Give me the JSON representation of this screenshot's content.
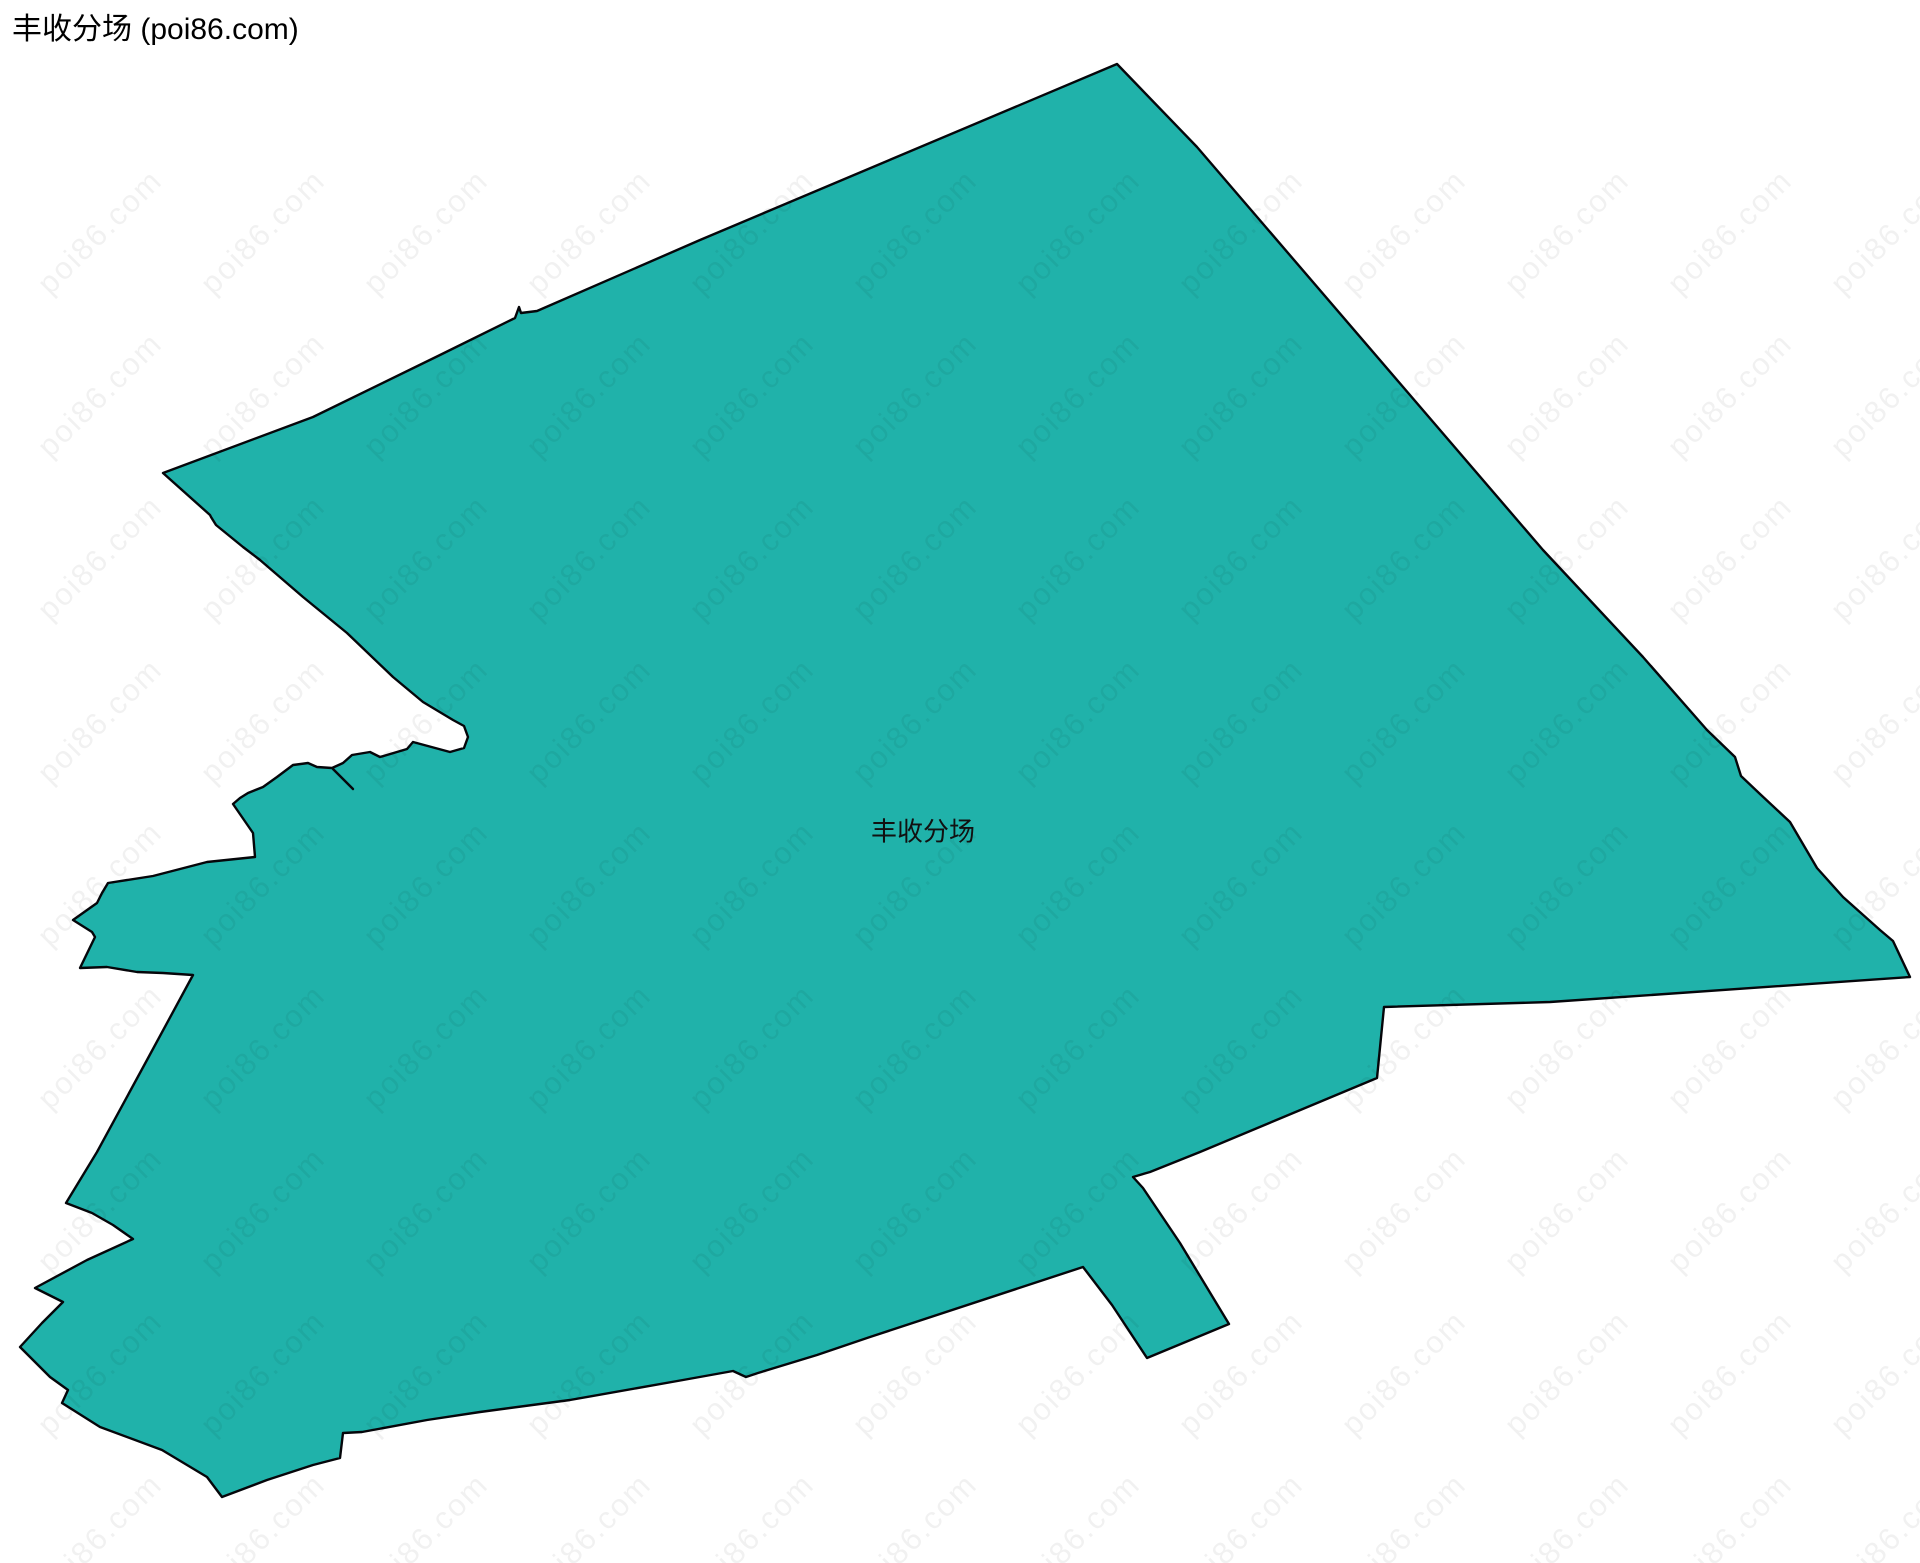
{
  "page": {
    "title": "丰收分场 (poi86.com)"
  },
  "map": {
    "region_label": "丰收分场",
    "label_position": {
      "x": 923,
      "y": 830
    },
    "fill_color": "#20B2AA",
    "stroke_color": "#05060a",
    "stroke_width": 2.4,
    "polygon_points": [
      [
        1117,
        64
      ],
      [
        1197,
        147
      ],
      [
        1543,
        550
      ],
      [
        1643,
        657
      ],
      [
        1707,
        730
      ],
      [
        1735,
        757
      ],
      [
        1741,
        776
      ],
      [
        1760,
        794
      ],
      [
        1790,
        822
      ],
      [
        1817,
        868
      ],
      [
        1843,
        897
      ],
      [
        1880,
        930
      ],
      [
        1893,
        941
      ],
      [
        1910,
        977
      ],
      [
        1550,
        1002
      ],
      [
        1384,
        1007
      ],
      [
        1377,
        1078
      ],
      [
        1200,
        1152
      ],
      [
        1150,
        1172
      ],
      [
        1133,
        1177
      ],
      [
        1143,
        1188
      ],
      [
        1180,
        1243
      ],
      [
        1229,
        1324
      ],
      [
        1147,
        1358
      ],
      [
        1112,
        1305
      ],
      [
        1083,
        1267
      ],
      [
        870,
        1337
      ],
      [
        817,
        1355
      ],
      [
        758,
        1373
      ],
      [
        746,
        1377
      ],
      [
        733,
        1371
      ],
      [
        683,
        1380
      ],
      [
        570,
        1400
      ],
      [
        480,
        1412
      ],
      [
        427,
        1420
      ],
      [
        362,
        1432
      ],
      [
        343,
        1433
      ],
      [
        340,
        1458
      ],
      [
        313,
        1465
      ],
      [
        267,
        1480
      ],
      [
        222,
        1497
      ],
      [
        207,
        1477
      ],
      [
        162,
        1450
      ],
      [
        100,
        1427
      ],
      [
        62,
        1403
      ],
      [
        68,
        1390
      ],
      [
        50,
        1377
      ],
      [
        20,
        1347
      ],
      [
        42,
        1323
      ],
      [
        63,
        1302
      ],
      [
        35,
        1288
      ],
      [
        87,
        1260
      ],
      [
        133,
        1239
      ],
      [
        113,
        1225
      ],
      [
        92,
        1213
      ],
      [
        66,
        1203
      ],
      [
        97,
        1152
      ],
      [
        147,
        1060
      ],
      [
        193,
        975
      ],
      [
        163,
        973
      ],
      [
        137,
        972
      ],
      [
        107,
        967
      ],
      [
        80,
        968
      ],
      [
        95,
        937
      ],
      [
        92,
        932
      ],
      [
        73,
        920
      ],
      [
        97,
        903
      ],
      [
        102,
        893
      ],
      [
        108,
        883
      ],
      [
        153,
        876
      ],
      [
        207,
        862
      ],
      [
        255,
        857
      ],
      [
        253,
        833
      ],
      [
        233,
        804
      ],
      [
        240,
        798
      ],
      [
        248,
        793
      ],
      [
        263,
        787
      ],
      [
        277,
        777
      ],
      [
        293,
        765
      ],
      [
        308,
        763
      ],
      [
        317,
        767
      ],
      [
        332,
        768
      ],
      [
        343,
        763
      ],
      [
        352,
        755
      ],
      [
        370,
        752
      ],
      [
        380,
        757
      ],
      [
        407,
        749
      ],
      [
        413,
        742
      ],
      [
        450,
        752
      ],
      [
        464,
        748
      ],
      [
        468,
        737
      ],
      [
        464,
        726
      ],
      [
        453,
        720
      ],
      [
        423,
        702
      ],
      [
        393,
        677
      ],
      [
        347,
        633
      ],
      [
        303,
        597
      ],
      [
        260,
        560
      ],
      [
        243,
        547
      ],
      [
        216,
        525
      ],
      [
        211,
        517
      ],
      [
        210,
        515
      ],
      [
        163,
        473
      ],
      [
        313,
        417
      ],
      [
        440,
        355
      ],
      [
        515,
        318
      ],
      [
        519,
        307
      ],
      [
        521,
        313
      ],
      [
        537,
        311
      ],
      [
        700,
        240
      ]
    ],
    "slit_line": {
      "x1": 333,
      "y1": 769,
      "x2": 353,
      "y2": 789
    }
  },
  "watermark": {
    "text": "poi86.com",
    "color": "rgba(0, 0, 0, 0.055)",
    "font_size": 31,
    "rotation_deg": -45,
    "grid": {
      "start_x": 100,
      "start_y": 232,
      "step_x": 163,
      "step_y": 163,
      "cols": 12,
      "rows": 9
    }
  }
}
